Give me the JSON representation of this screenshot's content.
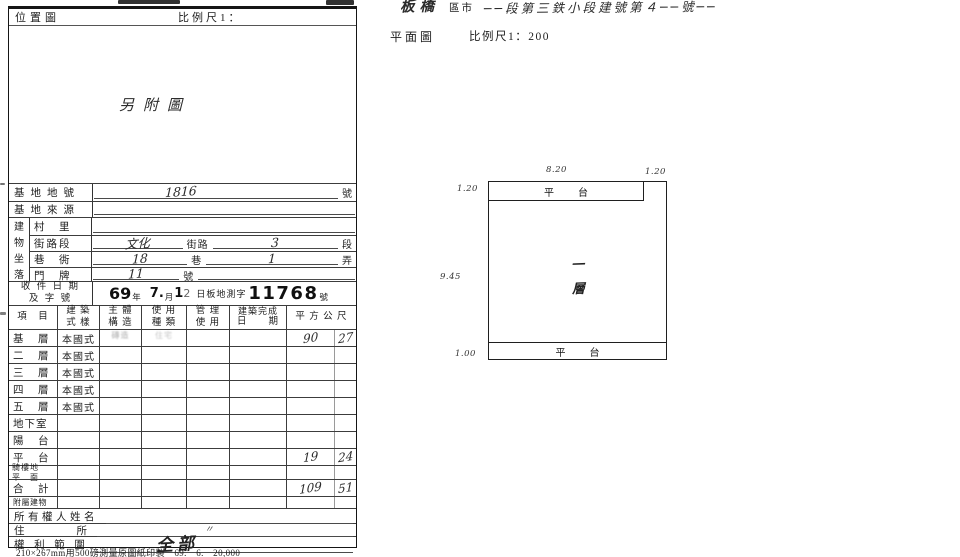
{
  "form": {
    "header": {
      "location_map_label": "位置圖",
      "scale_label": "比例尺1："
    },
    "map_note": "另附圖",
    "site_lot": {
      "label": "基地地號",
      "value": "1816",
      "unit": "號"
    },
    "site_source": {
      "label": "基地來源"
    },
    "location_group": {
      "chars": [
        "建",
        "物",
        "坐",
        "落"
      ]
    },
    "village": {
      "label": "村　里"
    },
    "street": {
      "label": "街路段",
      "hand_name": "文化",
      "print_mid": "街路",
      "hand_section": "3",
      "print_unit": "段"
    },
    "lane": {
      "label": "巷　衖",
      "hand_lane": "18",
      "print_mid": "巷",
      "hand_alley": "1",
      "print_unit": "弄"
    },
    "door": {
      "label": "門　牌",
      "hand_number": "11",
      "print_unit": "號"
    },
    "receipt": {
      "label_line1": "收 件 日 期",
      "label_line2": "及 字 號",
      "year": "69",
      "year_unit": "年",
      "month": "7.",
      "month_unit": "月",
      "day1": "1",
      "day2": "2",
      "office_text": "日板地測字",
      "doc_number": "11768",
      "number_unit": "號"
    },
    "table": {
      "headers": [
        {
          "l1": "項　目",
          "l2": ""
        },
        {
          "l1": "建 築",
          "l2": "式 樣"
        },
        {
          "l1": "主 體",
          "l2": "構 造"
        },
        {
          "l1": "使 用",
          "l2": "種 類"
        },
        {
          "l1": "管 理",
          "l2": "使 用"
        },
        {
          "l1": "建築完成",
          "l2": "日　　期"
        },
        {
          "l1": "平 方 公 尺",
          "l2": ""
        }
      ],
      "rows": [
        {
          "item": "基　層",
          "style": "本國式",
          "stamp_structure": "磚造",
          "stamp_use": "住宅",
          "area_int": "90",
          "area_dec": "27"
        },
        {
          "item": "二　層",
          "style": "本國式"
        },
        {
          "item": "三　層",
          "style": "本國式"
        },
        {
          "item": "四　層",
          "style": "本國式"
        },
        {
          "item": "五　層",
          "style": "本國式"
        },
        {
          "item": "地下室"
        },
        {
          "item": "陽　台"
        },
        {
          "item": "平　台",
          "area_int": "19",
          "area_dec": "24"
        },
        {
          "item": "騎樓地",
          "item_line2": "平　面"
        },
        {
          "item": "合　計",
          "area_int": "109",
          "area_dec": "51"
        },
        {
          "item": "附屬建物"
        }
      ],
      "owner_row": {
        "label": "所有權人姓名"
      },
      "address_row": {
        "label": "住　　　　所",
        "ditto_mark": "〃"
      },
      "rights_row": {
        "label": "權 利 範 圍",
        "value": "全部"
      }
    },
    "footer": "210×267mm用500磅測量原圖紙印製　69.　6.　20,000"
  },
  "plan": {
    "title": {
      "hand_prefix": "板橋",
      "print_label": "區市",
      "hand_suffix": "──段第三鉄小段建號第４──號──"
    },
    "subtitle": {
      "plan_label": "平面圖",
      "scale_label": "比例尺1：200"
    },
    "platform_top": "平　台",
    "platform_bottom": "平　台",
    "floor_char1": "一",
    "floor_char2": "層",
    "dims": {
      "top_width": "8.20",
      "top_right_width": "1.20",
      "top_strip_height": "1.20",
      "body_height": "9.45",
      "bottom_strip_height": "1.00"
    }
  }
}
